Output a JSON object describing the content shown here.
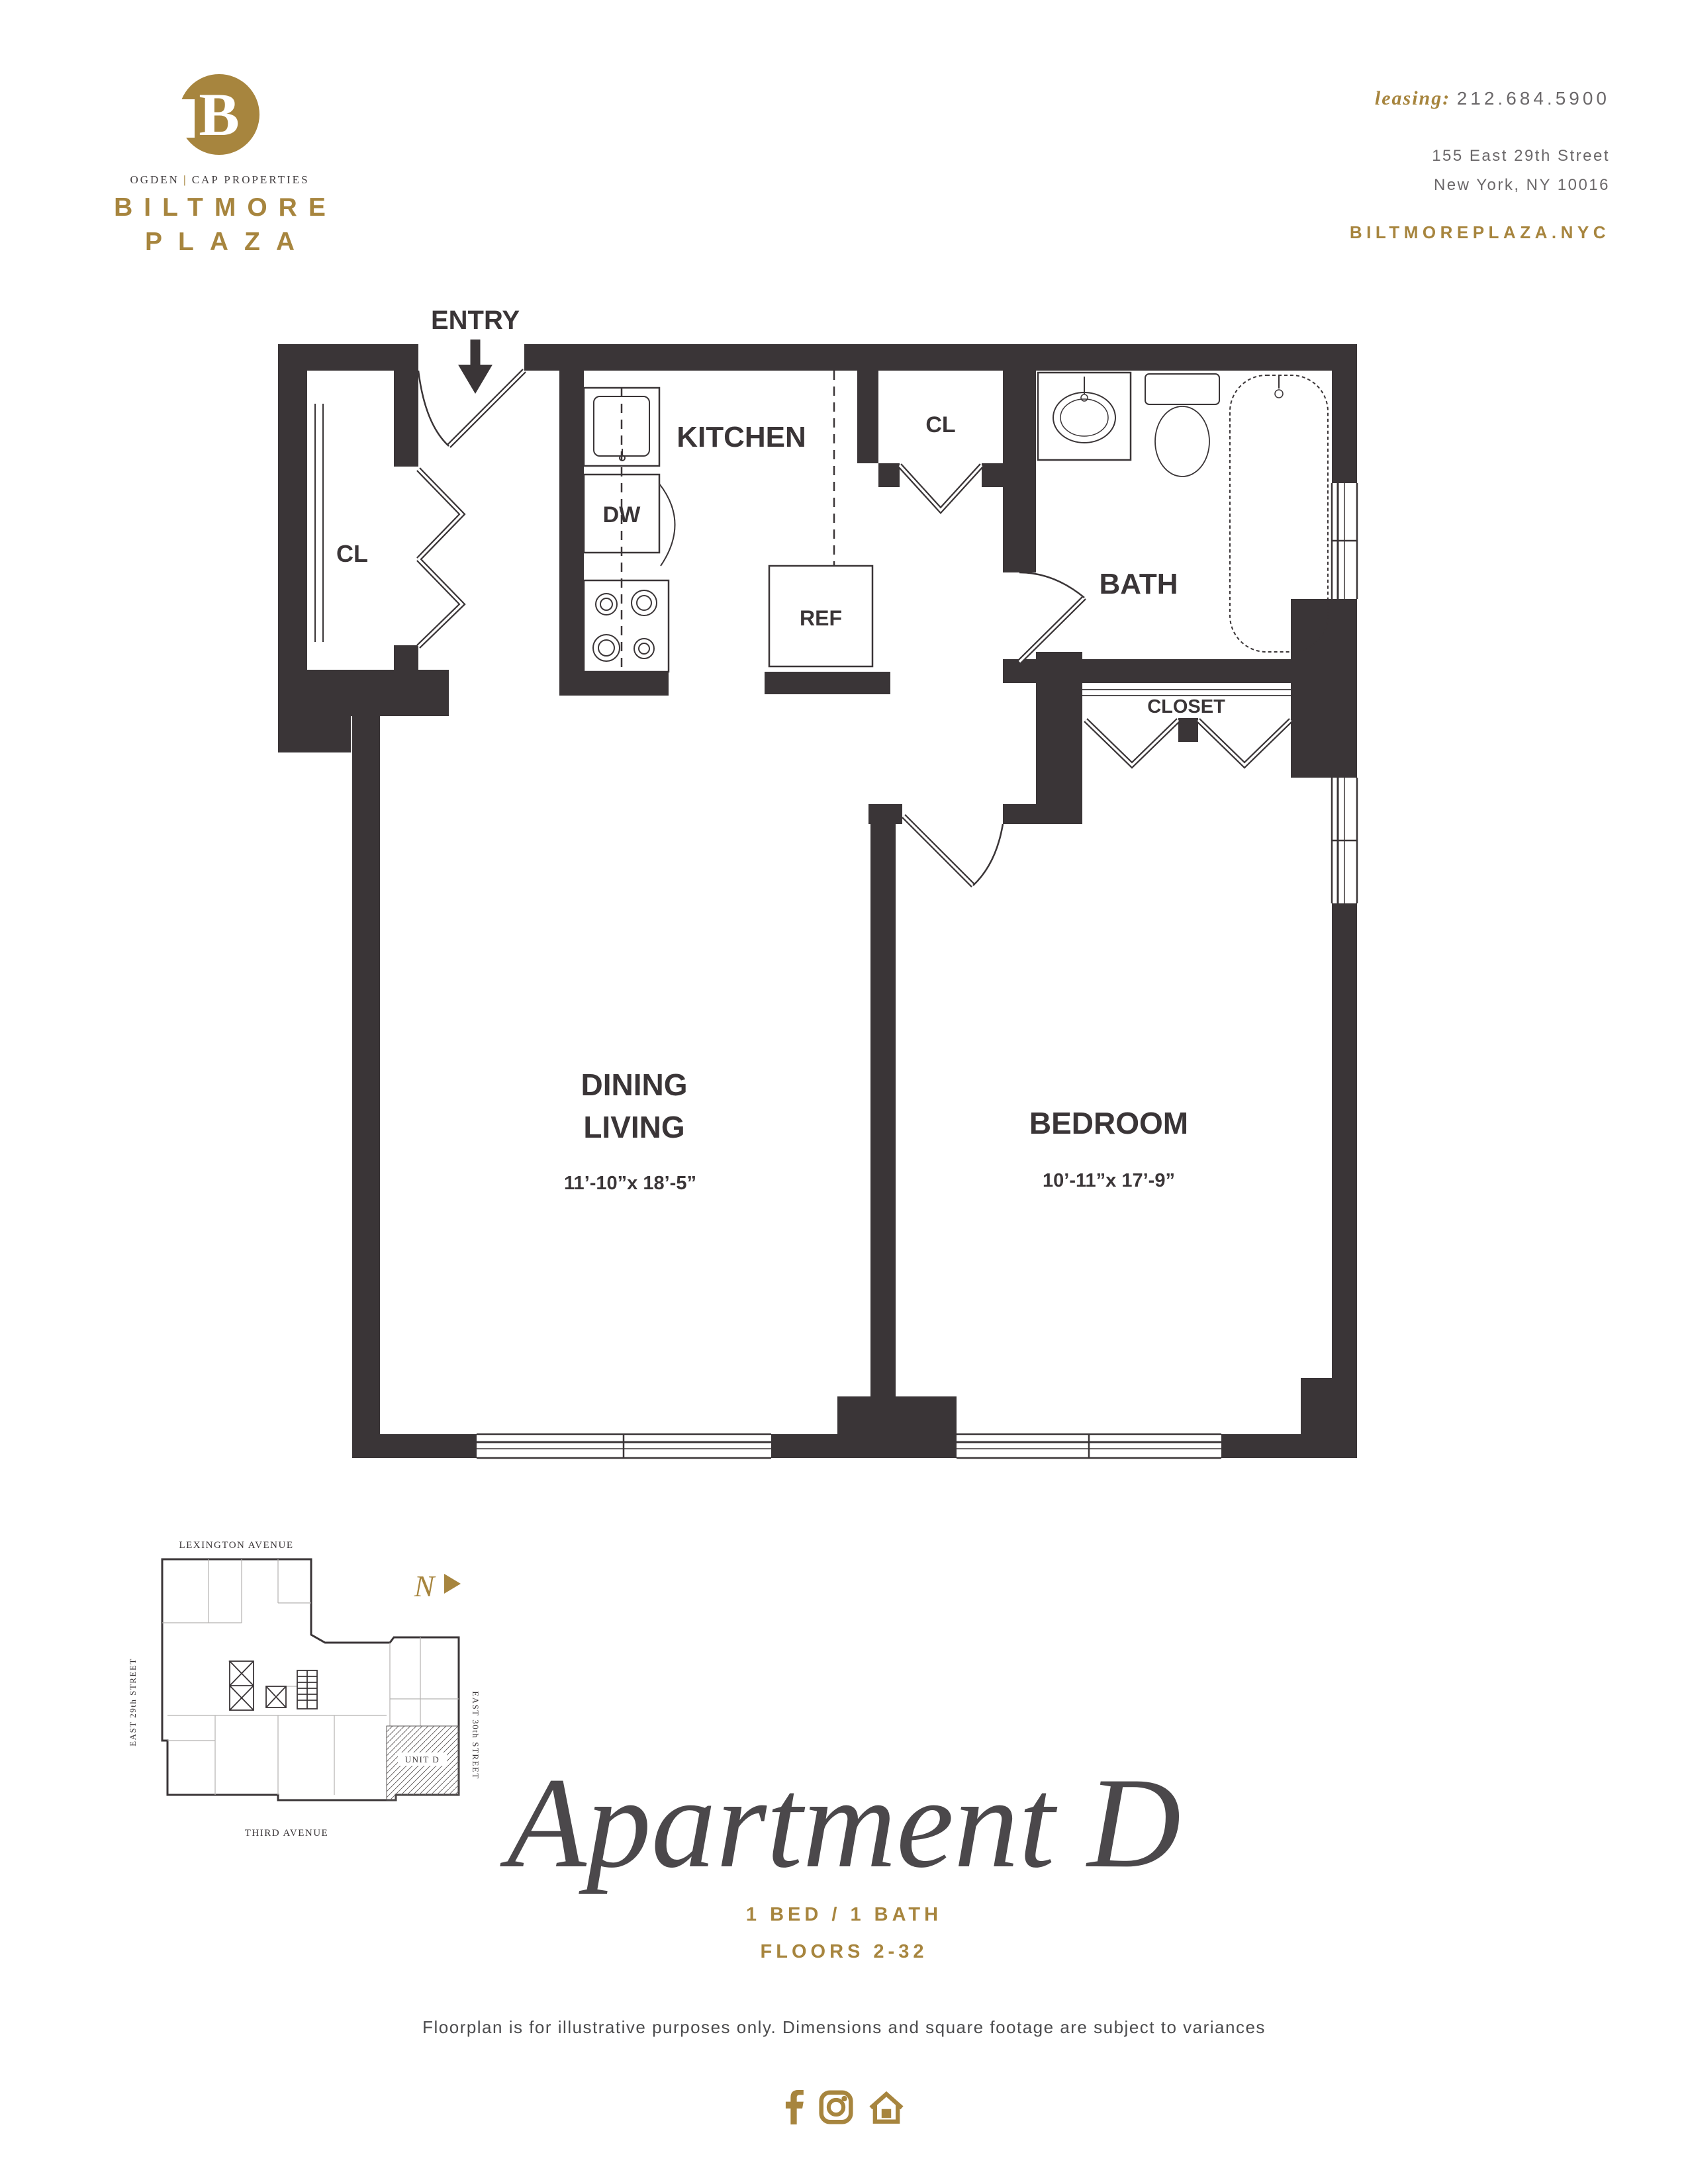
{
  "colors": {
    "gold": "#a7853e",
    "ink": "#3a3537",
    "gray": "#6b686a",
    "title_gray": "#4b484b"
  },
  "header": {
    "logo": {
      "initial": "B",
      "tagline_left": "OGDEN",
      "tagline_sep": "|",
      "tagline_right": "CAP PROPERTIES",
      "name_line1": "BILTMORE",
      "name_line2": "PLAZA"
    },
    "contact": {
      "leasing_label": "leasing:",
      "phone": "212.684.5900",
      "address1": "155 East 29th Street",
      "address2": "New York, NY 10016",
      "website": "BILTMOREPLAZA.NYC"
    }
  },
  "plan": {
    "entry": "ENTRY",
    "kitchen": "KITCHEN",
    "dw": "DW",
    "ref": "REF",
    "cl_left": "CL",
    "cl_hall": "CL",
    "bath": "BATH",
    "closet": "CLOSET",
    "dining_line1": "DINING",
    "dining_line2": "LIVING",
    "dining_dims": "11’-10”x 18’-5”",
    "bedroom": "BEDROOM",
    "bedroom_dims": "10’-11”x 17’-9”"
  },
  "siteplan": {
    "street_top": "LEXINGTON AVENUE",
    "street_left": "EAST 29th STREET",
    "street_right": "EAST 30th STREET",
    "street_bottom": "THIRD AVENUE",
    "north": "N",
    "unit": "UNIT D"
  },
  "footer": {
    "title": "Apartment D",
    "spec": "1 BED / 1 BATH",
    "floors": "FLOORS 2-32",
    "disclaimer": "Floorplan is for illustrative purposes only. Dimensions and square footage are subject to variances"
  }
}
